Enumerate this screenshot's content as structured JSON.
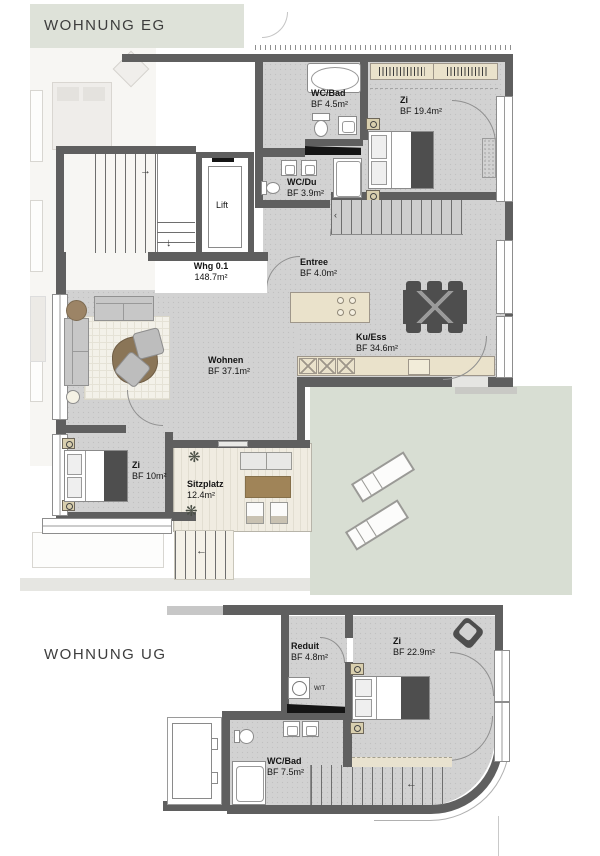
{
  "eg": {
    "title": "WOHNUNG EG",
    "rooms": {
      "wc_bad": {
        "name": "WC/Bad",
        "area": "BF 4.5m²"
      },
      "zi1": {
        "name": "Zi",
        "area": "BF 19.4m²"
      },
      "wc_du": {
        "name": "WC/Du",
        "area": "BF 3.9m²"
      },
      "lift": {
        "name": "Lift"
      },
      "whg": {
        "name": "Whg 0.1",
        "area": "148.7m²"
      },
      "entree": {
        "name": "Entree",
        "area": "BF 4.0m²"
      },
      "ku_ess": {
        "name": "Ku/Ess",
        "area": "BF 34.6m²"
      },
      "wohnen": {
        "name": "Wohnen",
        "area": "BF 37.1m²"
      },
      "zi2": {
        "name": "Zi",
        "area": "BF 10m²"
      },
      "sitzplatz": {
        "name": "Sitzplatz",
        "area": "12.4m²"
      }
    }
  },
  "ug": {
    "title": "WOHNUNG UG",
    "rooms": {
      "reduit": {
        "name": "Reduit",
        "area": "BF 4.8m²"
      },
      "zi": {
        "name": "Zi",
        "area": "BF 22.9m²"
      },
      "wc_bad": {
        "name": "WC/Bad",
        "area": "BF 7.5m²"
      },
      "wt": {
        "label": "W/T"
      }
    }
  },
  "colors": {
    "title_band": "#dee2d9",
    "lawn": "#d8ded3",
    "floor": "#d2d2d2",
    "wall": "#5f5f5f",
    "wood_beige": "#eae2cb",
    "terrace": "#f0ece1",
    "dark_furniture": "#4e4e4e",
    "table_brown": "#9c8062"
  }
}
